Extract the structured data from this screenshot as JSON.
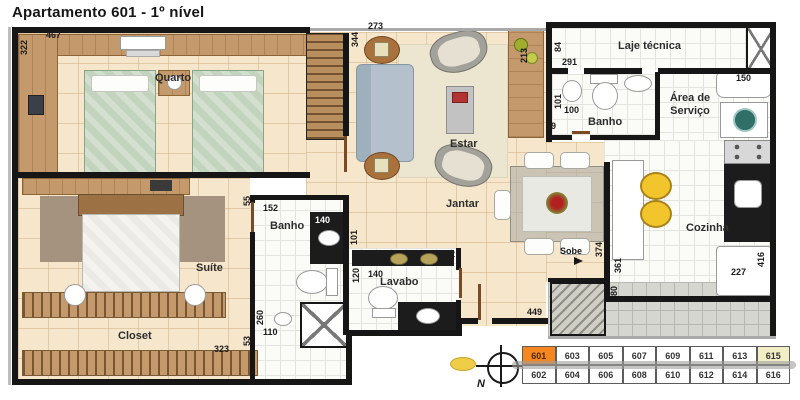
{
  "title": "Apartamento 601 - 1º nível",
  "rooms": {
    "quarto": "Quarto",
    "suite": "Suíte",
    "closet": "Closet",
    "banho_suite": "Banho",
    "lavabo": "Lavabo",
    "estar": "Estar",
    "jantar": "Jantar",
    "banho_social": "Banho",
    "laje_tecnica": "Laje técnica",
    "area_servico": "Área de Serviço",
    "cozinha": "Cozinha",
    "sobe": "Sobe"
  },
  "compass": {
    "north": "N"
  },
  "dimensions": [
    "467",
    "322",
    "273",
    "344",
    "213",
    "84",
    "291",
    "101",
    "100",
    "99",
    "150",
    "55",
    "152",
    "140",
    "260",
    "110",
    "101",
    "120",
    "140",
    "162",
    "449",
    "374",
    "361",
    "80",
    "227",
    "416",
    "323",
    "53"
  ],
  "legend": {
    "top_row": [
      "601",
      "603",
      "605",
      "607",
      "609",
      "611",
      "613",
      "615"
    ],
    "bottom_row": [
      "602",
      "604",
      "606",
      "608",
      "610",
      "612",
      "614",
      "616"
    ],
    "highlighted_unit": "601",
    "light_unit": "615"
  },
  "colors": {
    "wall": "#161616",
    "floor_cream": "#F6E7CC",
    "tile_white": "#FBFBF8",
    "wood": "#C49A6C",
    "bed_green": "#C2D4BD",
    "sofa_blue": "#B4C1CC",
    "rug_taupe": "#A5927F",
    "stool_yellow": "#F3C52D",
    "counter_black": "#1C1C1C",
    "unit_highlight": "#F6861F",
    "unit_light": "#F2EEC5"
  }
}
